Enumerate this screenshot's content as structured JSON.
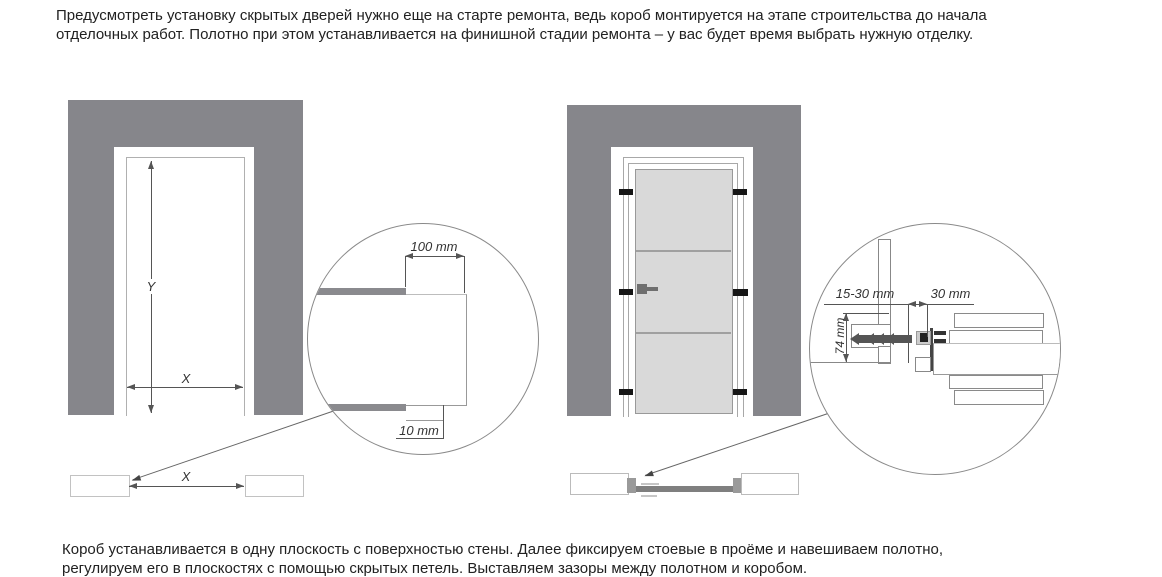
{
  "intro": {
    "line1": "Предусмотреть установку скрытых дверей нужно еще на старте ремонта, ведь короб монтируется на этапе строительства до начала",
    "line2": "отделочных работ. Полотно при этом устанавливается на финишной стадии ремонта – у вас будет время выбрать нужную отделку."
  },
  "footer": {
    "line1": "Короб устанавливается в одну плоскость с поверхностью стены. Далее фиксируем стоевые в проёме и навешиваем полотно,",
    "line2": "регулируем его в плоскостях с помощью скрытых петель. Выставляем зазоры между полотном и коробом."
  },
  "left_diagram": {
    "height_label": "Y",
    "width_label": "X",
    "plan_width_label": "X",
    "detail": {
      "frame_offset": "100 mm",
      "reveal_gap": "10 mm"
    }
  },
  "right_diagram": {
    "detail": {
      "finish_gap": "15-30 mm",
      "frame_depth": "30 mm",
      "anchor_height": "74 mm"
    }
  },
  "colors": {
    "wall": "#86868b",
    "door_leaf": "#d9d9d9",
    "plan_leaf": "#7f7f7f",
    "fitting_dark": "#555555",
    "clip_black": "#161616",
    "line": "#999999",
    "text": "#212121"
  }
}
